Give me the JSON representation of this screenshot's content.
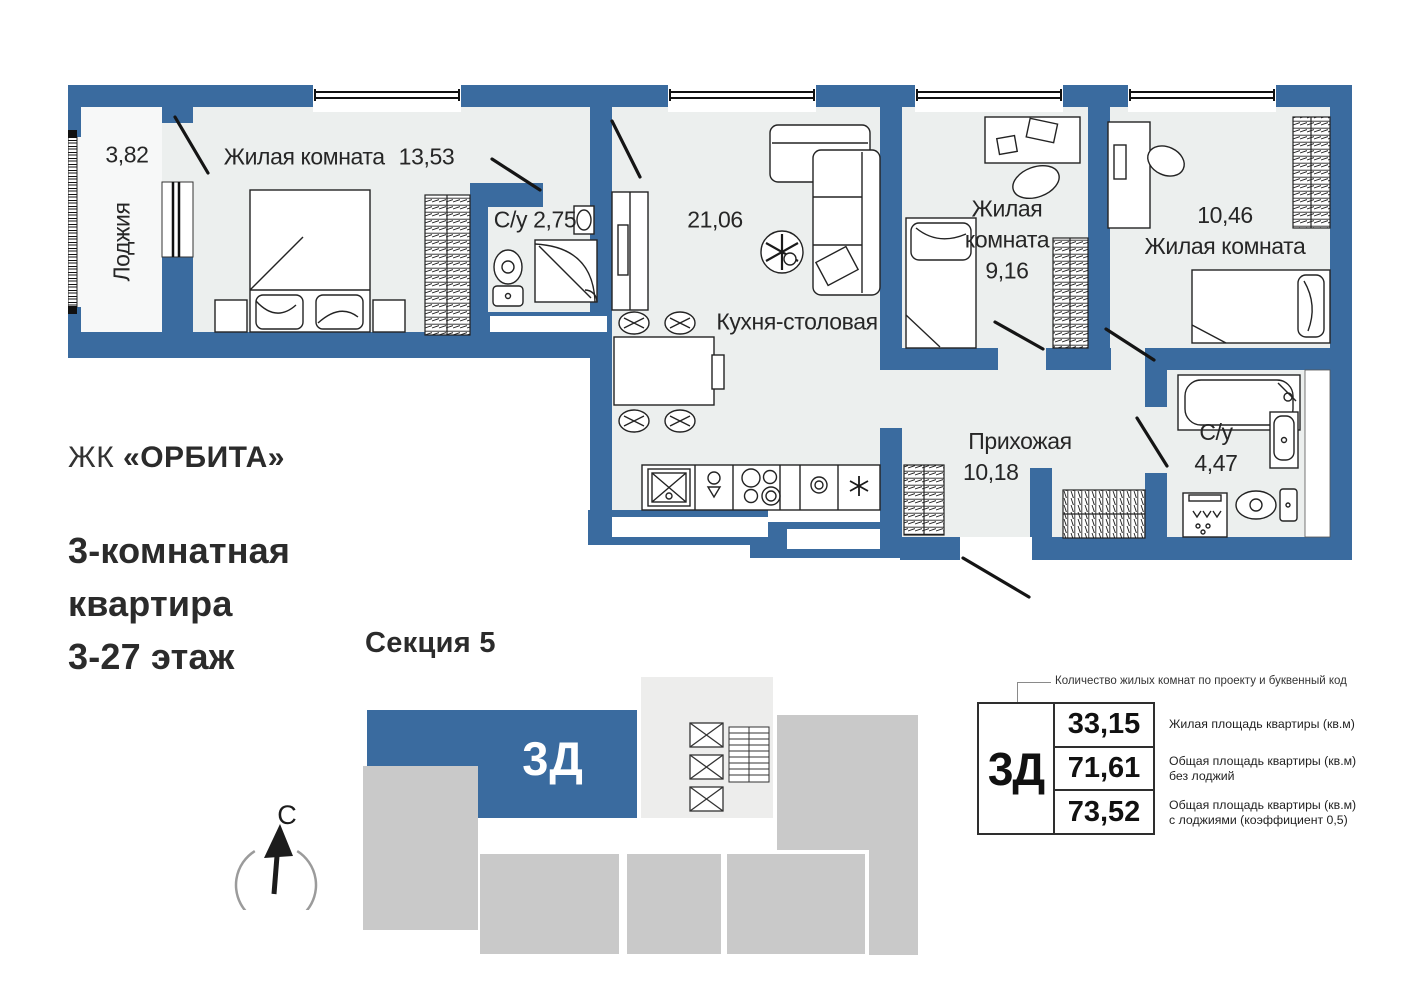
{
  "colors": {
    "wall": "#3a6b9f",
    "floor": "#ecefee",
    "loggia": "#f7f8f8",
    "blk": "#c9c9c9",
    "core": "#ededec",
    "ink": "#2b2b2b"
  },
  "branding": {
    "complex_prefix": "ЖК",
    "complex_name": "«ОРБИТА»",
    "apartment_line1": "3-комнатная",
    "apartment_line2": "квартира",
    "apartment_line3": "3-27 этаж"
  },
  "section": {
    "title": "Секция 5",
    "unit_code": "3Д"
  },
  "compass": {
    "north_label": "С"
  },
  "plan": {
    "rooms": {
      "loggia": {
        "name": "Лоджия",
        "area": "3,82"
      },
      "bedroom1": {
        "name": "Жилая комната",
        "area": "13,53"
      },
      "bath1": {
        "name": "С/у",
        "area": "2,75"
      },
      "kitchen": {
        "name": "Кухня-столовая",
        "area": "21,06"
      },
      "bedroom2": {
        "name": "Жилая комната",
        "area": "9,16"
      },
      "bedroom3": {
        "name": "Жилая комната",
        "area": "10,46"
      },
      "hallway": {
        "name": "Прихожая",
        "area": "10,18"
      },
      "bath2": {
        "name": "С/у",
        "area": "4,47"
      }
    }
  },
  "info_table": {
    "callout": "Количество жилых комнат по проекту и буквенный код",
    "unit_code": "3Д",
    "rows": [
      {
        "value": "33,15",
        "label": "Жилая площадь квартиры (кв.м)"
      },
      {
        "value": "71,61",
        "label": "Общая площадь квартиры (кв.м) без лоджий"
      },
      {
        "value": "73,52",
        "label": "Общая площадь квартиры (кв.м) с лоджиями (коэффициент 0,5)"
      }
    ]
  }
}
